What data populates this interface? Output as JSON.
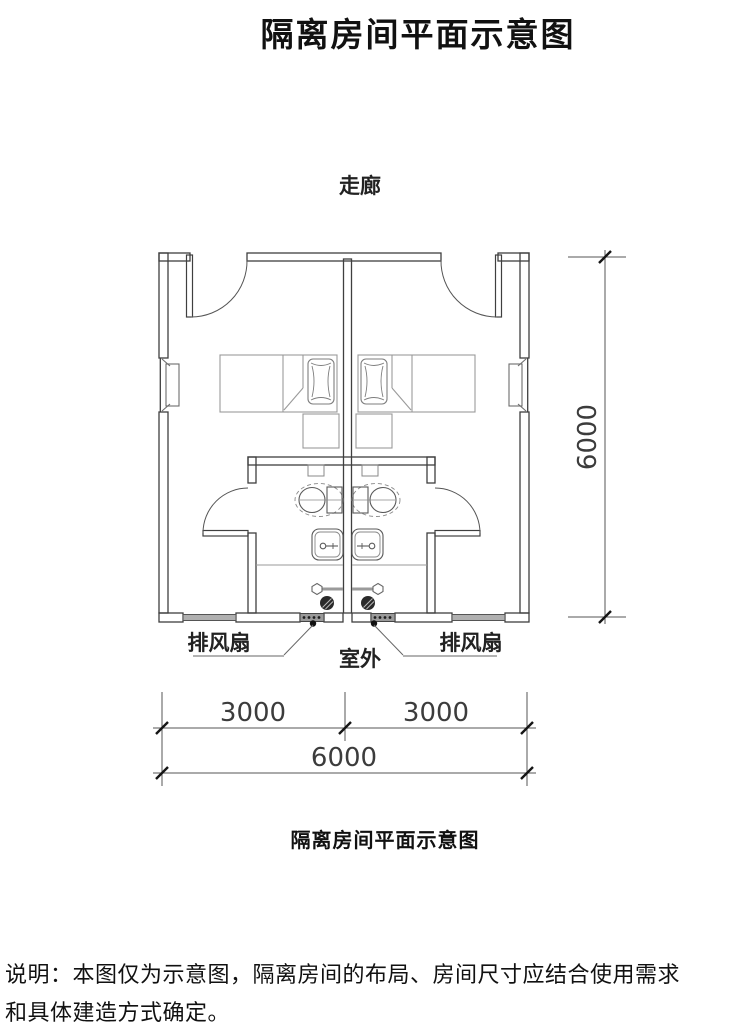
{
  "document": {
    "title": "隔离房间平面示意图",
    "figure_caption": "隔离房间平面示意图",
    "note": "说明：本图仅为示意图，隔离房间的布局、房间尺寸应结合使用需求和具体建造方式确定。"
  },
  "plan": {
    "corridor_label": "走廊",
    "outdoor_label": "室外",
    "exhaust_fan_left_label": "排风扇",
    "exhaust_fan_right_label": "排风扇",
    "dimensions": {
      "room_width_left": "3000",
      "room_width_right": "3000",
      "total_width": "6000",
      "total_height": "6000"
    },
    "colors": {
      "wall_line": "#3f3f3f",
      "furniture_line": "#9a9a9a",
      "fixture_line": "#666666",
      "window_fill": "#b0b0b0",
      "vent_fill": "#9a9a9a",
      "dimension_line": "#555555",
      "text": "#1a1a1a"
    }
  }
}
